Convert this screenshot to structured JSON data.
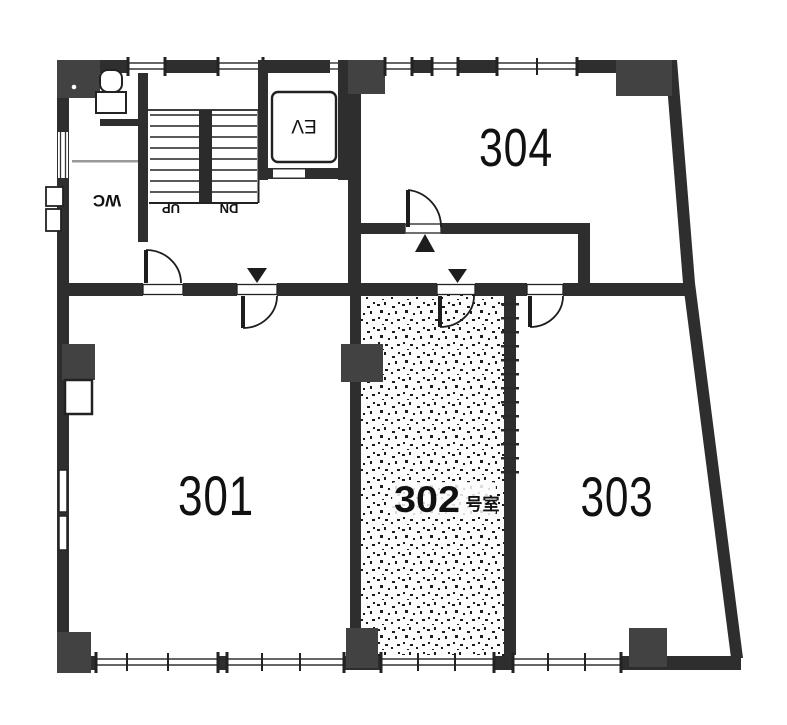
{
  "plan": {
    "kind": "scanned architectural floor plan",
    "rooms": {
      "r301": {
        "label": "301"
      },
      "r302": {
        "number": "302",
        "suffix": "号室"
      },
      "r303": {
        "label": "303"
      },
      "r304": {
        "label": "304"
      }
    },
    "stairwell": {
      "up_label": "UP",
      "down_label": "DN"
    },
    "fixtures": {
      "elevator_label": "EV",
      "toilet_label": "WC"
    },
    "colors": {
      "wall": "#2e2e2e",
      "column": "#424242",
      "paper": "#ffffff",
      "ink": "#111111",
      "stipple_dot": "#1c1c1c"
    }
  }
}
